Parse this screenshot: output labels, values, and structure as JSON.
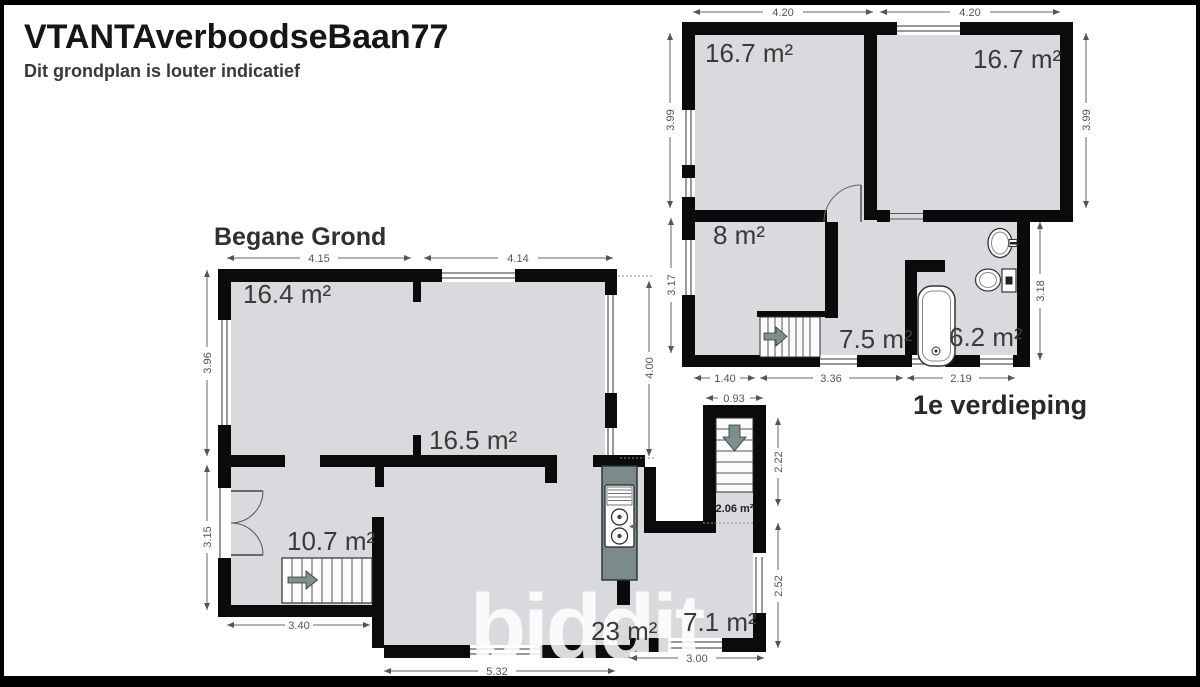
{
  "header": {
    "title": "VTANTAverboodseBaan77",
    "subtitle": "Dit grondplan is louter indicatief"
  },
  "watermark": {
    "text": "biddit"
  },
  "ground_floor": {
    "title": "Begane Grond",
    "rooms": {
      "living": "16.4 m²",
      "dining": "16.5 m²",
      "hall": "10.7 m²",
      "kitchen_living": "23 m²",
      "back_room": "7.1 m²",
      "stairwell": "2.06 m²"
    },
    "dims": {
      "top_left": "4.15",
      "top_right": "4.14",
      "left_upper": "3.96",
      "left_lower": "3.15",
      "right_upper": "4.00",
      "bottom_hall": "3.40",
      "bottom_main": "5.32",
      "stair_width": "0.93",
      "stair_depth": "2.22",
      "back_depth": "2.52",
      "back_width": "3.00"
    }
  },
  "first_floor": {
    "title": "1e verdieping",
    "rooms": {
      "bedroom_left": "16.7 m²",
      "bedroom_right": "16.7 m²",
      "bedroom_small": "8 m²",
      "landing": "7.5 m²",
      "bathroom": "6.2 m²"
    },
    "dims": {
      "top_left": "4.20",
      "top_right": "4.20",
      "left_upper": "3.99",
      "right_upper": "3.99",
      "left_lower": "3.17",
      "right_lower": "3.18",
      "bottom_left": "1.40",
      "bottom_mid": "3.36",
      "bottom_right": "2.19"
    }
  },
  "colors": {
    "wall": "#0b0b0b",
    "floor": "#d9dadd",
    "kitchen_counter": "#7b8a8a",
    "stair_arrow": "#7f8e8e",
    "frame": "#000000"
  }
}
